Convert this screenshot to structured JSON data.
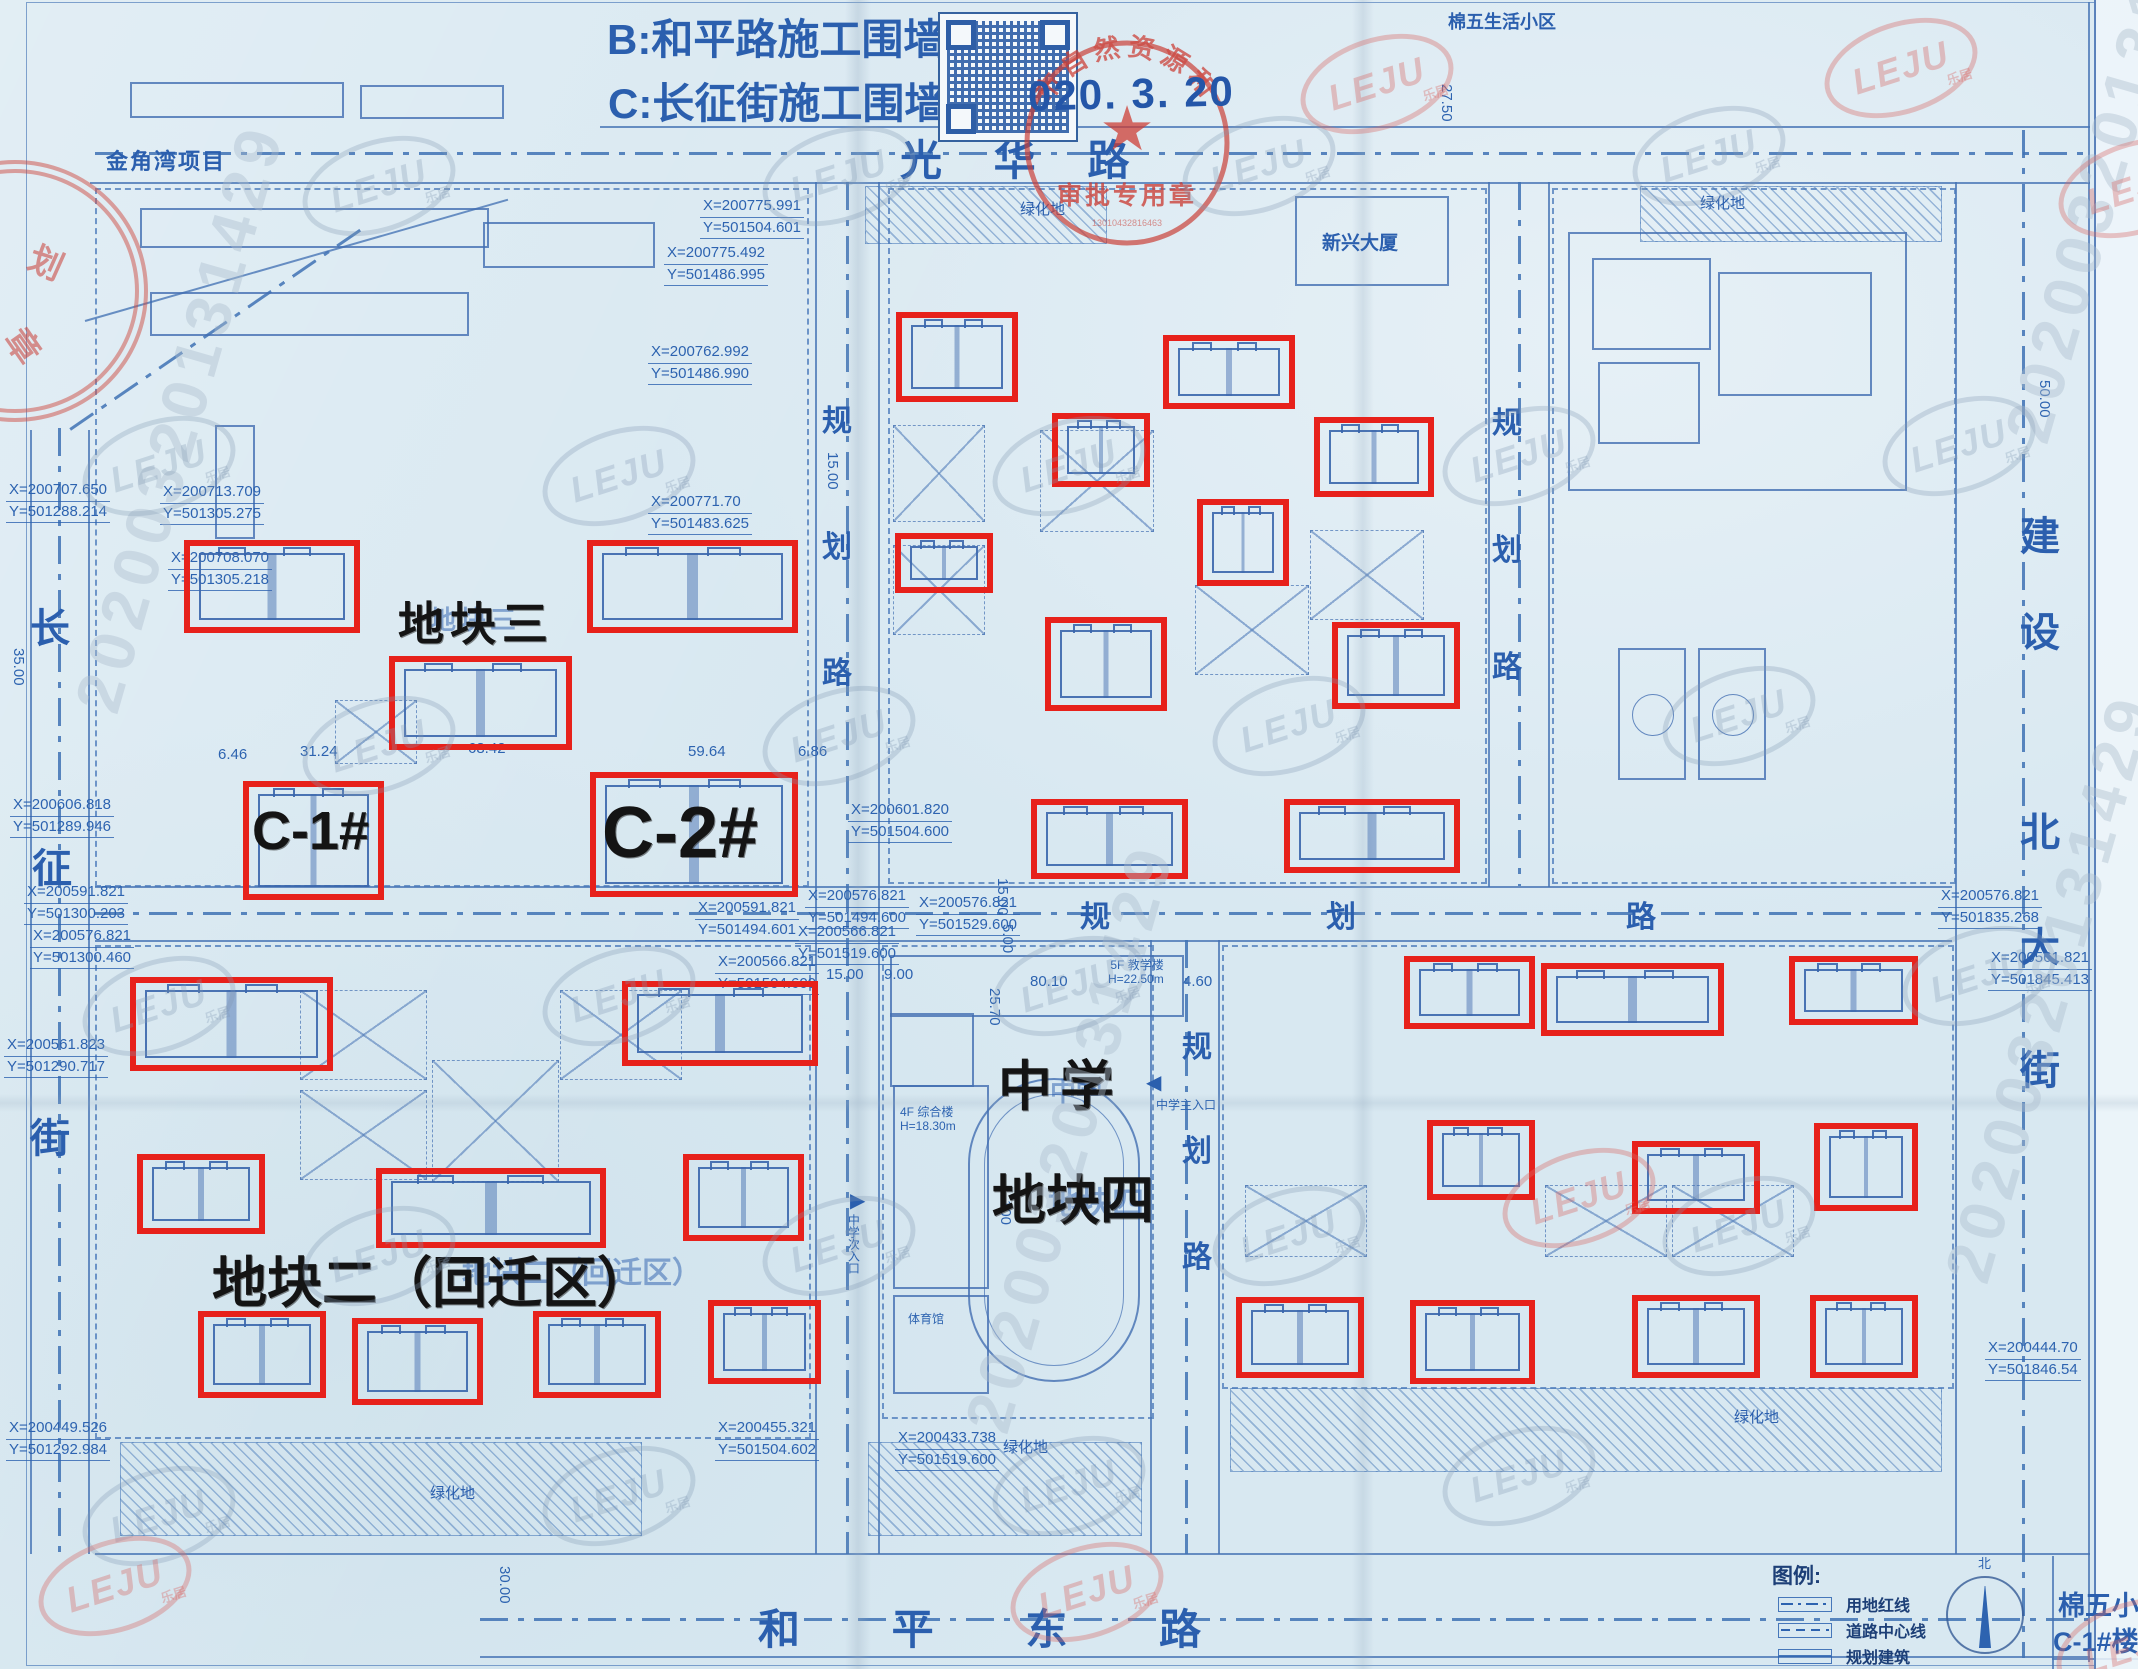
{
  "notes": {
    "line_b": "B:和平路施工围墙。",
    "line_c": "C:长征街施工围墙。",
    "approval_date": "020. 3. 20"
  },
  "stamp": {
    "ring_text": "市自然资源和",
    "center_label": "审批专用章",
    "serial": "13010432816463"
  },
  "roads": {
    "guanghua": "光 华 路",
    "heping_east": "和  平  东  路"
  },
  "areas": {
    "jinjiaowan": "金角湾项目",
    "mianwu_living": "棉五生活小区",
    "xinxing": "新兴大厦",
    "plot3": "地块三",
    "plot4": "地块四",
    "plot2": "地块二（回迁区）",
    "school": "中学",
    "c1": "C-1#",
    "c2": "C-2#",
    "green": "绿化地"
  },
  "school_labels": {
    "teach": "5F 教学楼",
    "teach_h": "H=22.50m",
    "general": "4F 综合楼",
    "general_h": "H=18.30m",
    "gym": "体育馆",
    "entry_main": "中学主入口",
    "entry_side": "中学次入口",
    "arrow_left": "◀",
    "arrow_right": "▶"
  },
  "legend": {
    "title": "图例:",
    "items": [
      "用地红线",
      "道路中心线",
      "规划建筑"
    ],
    "north": "北",
    "site_name": "棉五小区",
    "building_name": "C-1#楼"
  },
  "watermark": {
    "logo": "LEJU",
    "logo_sub": "乐居",
    "code": "20200320131429"
  },
  "road_chars": [
    {
      "c": "长",
      "l": 30,
      "t": 596,
      "s": 40
    },
    {
      "c": "征",
      "l": 32,
      "t": 836,
      "s": 40
    },
    {
      "c": "街",
      "l": 30,
      "t": 1106,
      "s": 40
    },
    {
      "c": "建",
      "l": 2020,
      "t": 504,
      "s": 40
    },
    {
      "c": "设",
      "l": 2020,
      "t": 600,
      "s": 40
    },
    {
      "c": "北",
      "l": 2020,
      "t": 800,
      "s": 40
    },
    {
      "c": "大",
      "l": 2020,
      "t": 915,
      "s": 40
    },
    {
      "c": "街",
      "l": 2020,
      "t": 1038,
      "s": 40
    },
    {
      "c": "规",
      "l": 822,
      "t": 396,
      "s": 30
    },
    {
      "c": "划",
      "l": 822,
      "t": 522,
      "s": 30
    },
    {
      "c": "路",
      "l": 822,
      "t": 648,
      "s": 30
    },
    {
      "c": "规",
      "l": 1492,
      "t": 398,
      "s": 30
    },
    {
      "c": "划",
      "l": 1492,
      "t": 525,
      "s": 30
    },
    {
      "c": "路",
      "l": 1492,
      "t": 642,
      "s": 30
    },
    {
      "c": "规",
      "l": 1080,
      "t": 892,
      "s": 30
    },
    {
      "c": "划",
      "l": 1326,
      "t": 892,
      "s": 30
    },
    {
      "c": "路",
      "l": 1626,
      "t": 892,
      "s": 30
    },
    {
      "c": "规",
      "l": 1182,
      "t": 1022,
      "s": 30
    },
    {
      "c": "划",
      "l": 1182,
      "t": 1126,
      "s": 30
    },
    {
      "c": "路",
      "l": 1182,
      "t": 1232,
      "s": 30
    }
  ],
  "coord_labels": [
    {
      "x": "X=200775.991",
      "y": "Y=501504.601",
      "l": 700,
      "t": 196
    },
    {
      "x": "X=200775.492",
      "y": "Y=501486.995",
      "l": 664,
      "t": 243
    },
    {
      "x": "X=200762.992",
      "y": "Y=501486.990",
      "l": 648,
      "t": 342
    },
    {
      "x": "X=200771.70",
      "y": "Y=501483.625",
      "l": 648,
      "t": 492
    },
    {
      "x": "X=200713.709",
      "y": "Y=501305.275",
      "l": 160,
      "t": 482
    },
    {
      "x": "X=200708.070",
      "y": "Y=501305.218",
      "l": 168,
      "t": 548
    },
    {
      "x": "X=200707.650",
      "y": "Y=501288.214",
      "l": 6,
      "t": 480
    },
    {
      "x": "X=200606.818",
      "y": "Y=501289.946",
      "l": 10,
      "t": 795
    },
    {
      "x": "X=200591.821",
      "y": "Y=501300.203",
      "l": 24,
      "t": 882
    },
    {
      "x": "X=200576.821",
      "y": "Y=501300.460",
      "l": 30,
      "t": 926
    },
    {
      "x": "X=200561.823",
      "y": "Y=501290.717",
      "l": 4,
      "t": 1035
    },
    {
      "x": "X=200449.526",
      "y": "Y=501292.984",
      "l": 6,
      "t": 1418
    },
    {
      "x": "X=200601.820",
      "y": "Y=501504.600",
      "l": 848,
      "t": 800
    },
    {
      "x": "X=200591.821",
      "y": "Y=501494.601",
      "l": 695,
      "t": 898
    },
    {
      "x": "X=200576.821",
      "y": "Y=501494.600",
      "l": 805,
      "t": 886
    },
    {
      "x": "X=200576.821",
      "y": "Y=501529.600",
      "l": 916,
      "t": 893
    },
    {
      "x": "X=200566.821",
      "y": "Y=501519.600",
      "l": 795,
      "t": 922
    },
    {
      "x": "X=200566.821",
      "y": "Y=501504.600",
      "l": 715,
      "t": 952
    },
    {
      "x": "X=200576.821",
      "y": "Y=501835.268",
      "l": 1938,
      "t": 886
    },
    {
      "x": "X=200561.821",
      "y": "Y=501845.413",
      "l": 1988,
      "t": 948
    },
    {
      "x": "X=200455.321",
      "y": "Y=501504.602",
      "l": 715,
      "t": 1418
    },
    {
      "x": "X=200433.738",
      "y": "Y=501519.600",
      "l": 895,
      "t": 1428
    },
    {
      "x": "X=200444.70",
      "y": "Y=501846.54",
      "l": 1985,
      "t": 1338
    }
  ],
  "dims": [
    {
      "t": "6.46",
      "l": 218,
      "y": 746
    },
    {
      "t": "31.24",
      "l": 300,
      "y": 743
    },
    {
      "t": "68.42",
      "l": 468,
      "y": 740
    },
    {
      "t": "59.64",
      "l": 688,
      "y": 743
    },
    {
      "t": "6.86",
      "l": 798,
      "y": 743
    },
    {
      "t": "15.00",
      "l": 824,
      "y": 452,
      "v": 1
    },
    {
      "t": "15.00",
      "l": 826,
      "y": 966
    },
    {
      "t": "9.00",
      "l": 884,
      "y": 966
    },
    {
      "t": "15.00",
      "l": 994,
      "y": 878,
      "v": 1
    },
    {
      "t": "5.00",
      "l": 999,
      "y": 924,
      "v": 1
    },
    {
      "t": "25.70",
      "l": 986,
      "y": 988,
      "v": 1
    },
    {
      "t": "80.10",
      "l": 1030,
      "y": 973
    },
    {
      "t": "4.60",
      "l": 1183,
      "y": 973
    },
    {
      "t": "27.50",
      "l": 1438,
      "y": 84,
      "v": 1
    },
    {
      "t": "50.00",
      "l": 2036,
      "y": 380,
      "v": 1
    },
    {
      "t": "35.00",
      "l": 10,
      "y": 648,
      "v": 1
    },
    {
      "t": "30.00",
      "l": 496,
      "y": 1566,
      "v": 1
    },
    {
      "t": "100",
      "l": 997,
      "y": 1200,
      "v": 1
    }
  ],
  "red_boxes": [
    [
      896,
      312,
      110,
      78
    ],
    [
      1163,
      335,
      120,
      62
    ],
    [
      1052,
      413,
      86,
      62
    ],
    [
      1314,
      417,
      108,
      68
    ],
    [
      1197,
      499,
      80,
      75
    ],
    [
      895,
      533,
      86,
      48
    ],
    [
      1045,
      617,
      110,
      82
    ],
    [
      1332,
      622,
      116,
      75
    ],
    [
      1031,
      799,
      145,
      68
    ],
    [
      1284,
      799,
      164,
      62
    ],
    [
      184,
      540,
      164,
      81
    ],
    [
      587,
      540,
      199,
      81
    ],
    [
      389,
      656,
      171,
      82
    ],
    [
      243,
      781,
      129,
      107
    ],
    [
      590,
      772,
      196,
      113
    ],
    [
      130,
      977,
      191,
      82
    ],
    [
      622,
      981,
      184,
      73
    ],
    [
      137,
      1154,
      116,
      68
    ],
    [
      376,
      1168,
      218,
      68
    ],
    [
      683,
      1154,
      109,
      75
    ],
    [
      198,
      1311,
      116,
      75
    ],
    [
      352,
      1318,
      119,
      75
    ],
    [
      533,
      1311,
      116,
      75
    ],
    [
      708,
      1300,
      101,
      72
    ],
    [
      1404,
      956,
      119,
      61
    ],
    [
      1541,
      963,
      171,
      61
    ],
    [
      1789,
      956,
      117,
      57
    ],
    [
      1427,
      1120,
      96,
      68
    ],
    [
      1632,
      1141,
      116,
      61
    ],
    [
      1814,
      1123,
      92,
      76
    ],
    [
      1236,
      1297,
      116,
      69
    ],
    [
      1410,
      1300,
      113,
      72
    ],
    [
      1632,
      1295,
      116,
      71
    ],
    [
      1810,
      1295,
      96,
      71
    ]
  ],
  "wms": [
    {
      "l": 300,
      "t": 140
    },
    {
      "l": 760,
      "t": 130
    },
    {
      "l": 1180,
      "t": 120
    },
    {
      "l": 1630,
      "t": 110
    },
    {
      "l": 80,
      "t": 420
    },
    {
      "l": 540,
      "t": 430
    },
    {
      "l": 990,
      "t": 420
    },
    {
      "l": 1440,
      "t": 410
    },
    {
      "l": 1880,
      "t": 400
    },
    {
      "l": 300,
      "t": 700
    },
    {
      "l": 760,
      "t": 690
    },
    {
      "l": 1210,
      "t": 680
    },
    {
      "l": 1660,
      "t": 670
    },
    {
      "l": 80,
      "t": 960
    },
    {
      "l": 540,
      "t": 950
    },
    {
      "l": 990,
      "t": 940
    },
    {
      "l": 1900,
      "t": 930
    },
    {
      "l": 300,
      "t": 1210
    },
    {
      "l": 760,
      "t": 1200
    },
    {
      "l": 1210,
      "t": 1190
    },
    {
      "l": 1660,
      "t": 1180
    },
    {
      "l": 540,
      "t": 1450
    },
    {
      "l": 990,
      "t": 1440
    },
    {
      "l": 1440,
      "t": 1430
    },
    {
      "l": 80,
      "t": 1470
    },
    {
      "l": 1298,
      "t": 38,
      "red": 1
    },
    {
      "l": 1822,
      "t": 22,
      "red": 1
    },
    {
      "l": 2056,
      "t": 142,
      "red": 1
    },
    {
      "l": 1500,
      "t": 1152,
      "red": 1
    },
    {
      "l": 36,
      "t": 1540,
      "red": 1
    },
    {
      "l": 1008,
      "t": 1546,
      "red": 1
    },
    {
      "l": 2054,
      "t": 1602,
      "red": 1
    }
  ],
  "codes": [
    {
      "l": 60,
      "t": 700
    },
    {
      "l": 950,
      "t": 1420
    },
    {
      "l": 1990,
      "t": 430
    },
    {
      "l": 1930,
      "t": 1270
    }
  ]
}
